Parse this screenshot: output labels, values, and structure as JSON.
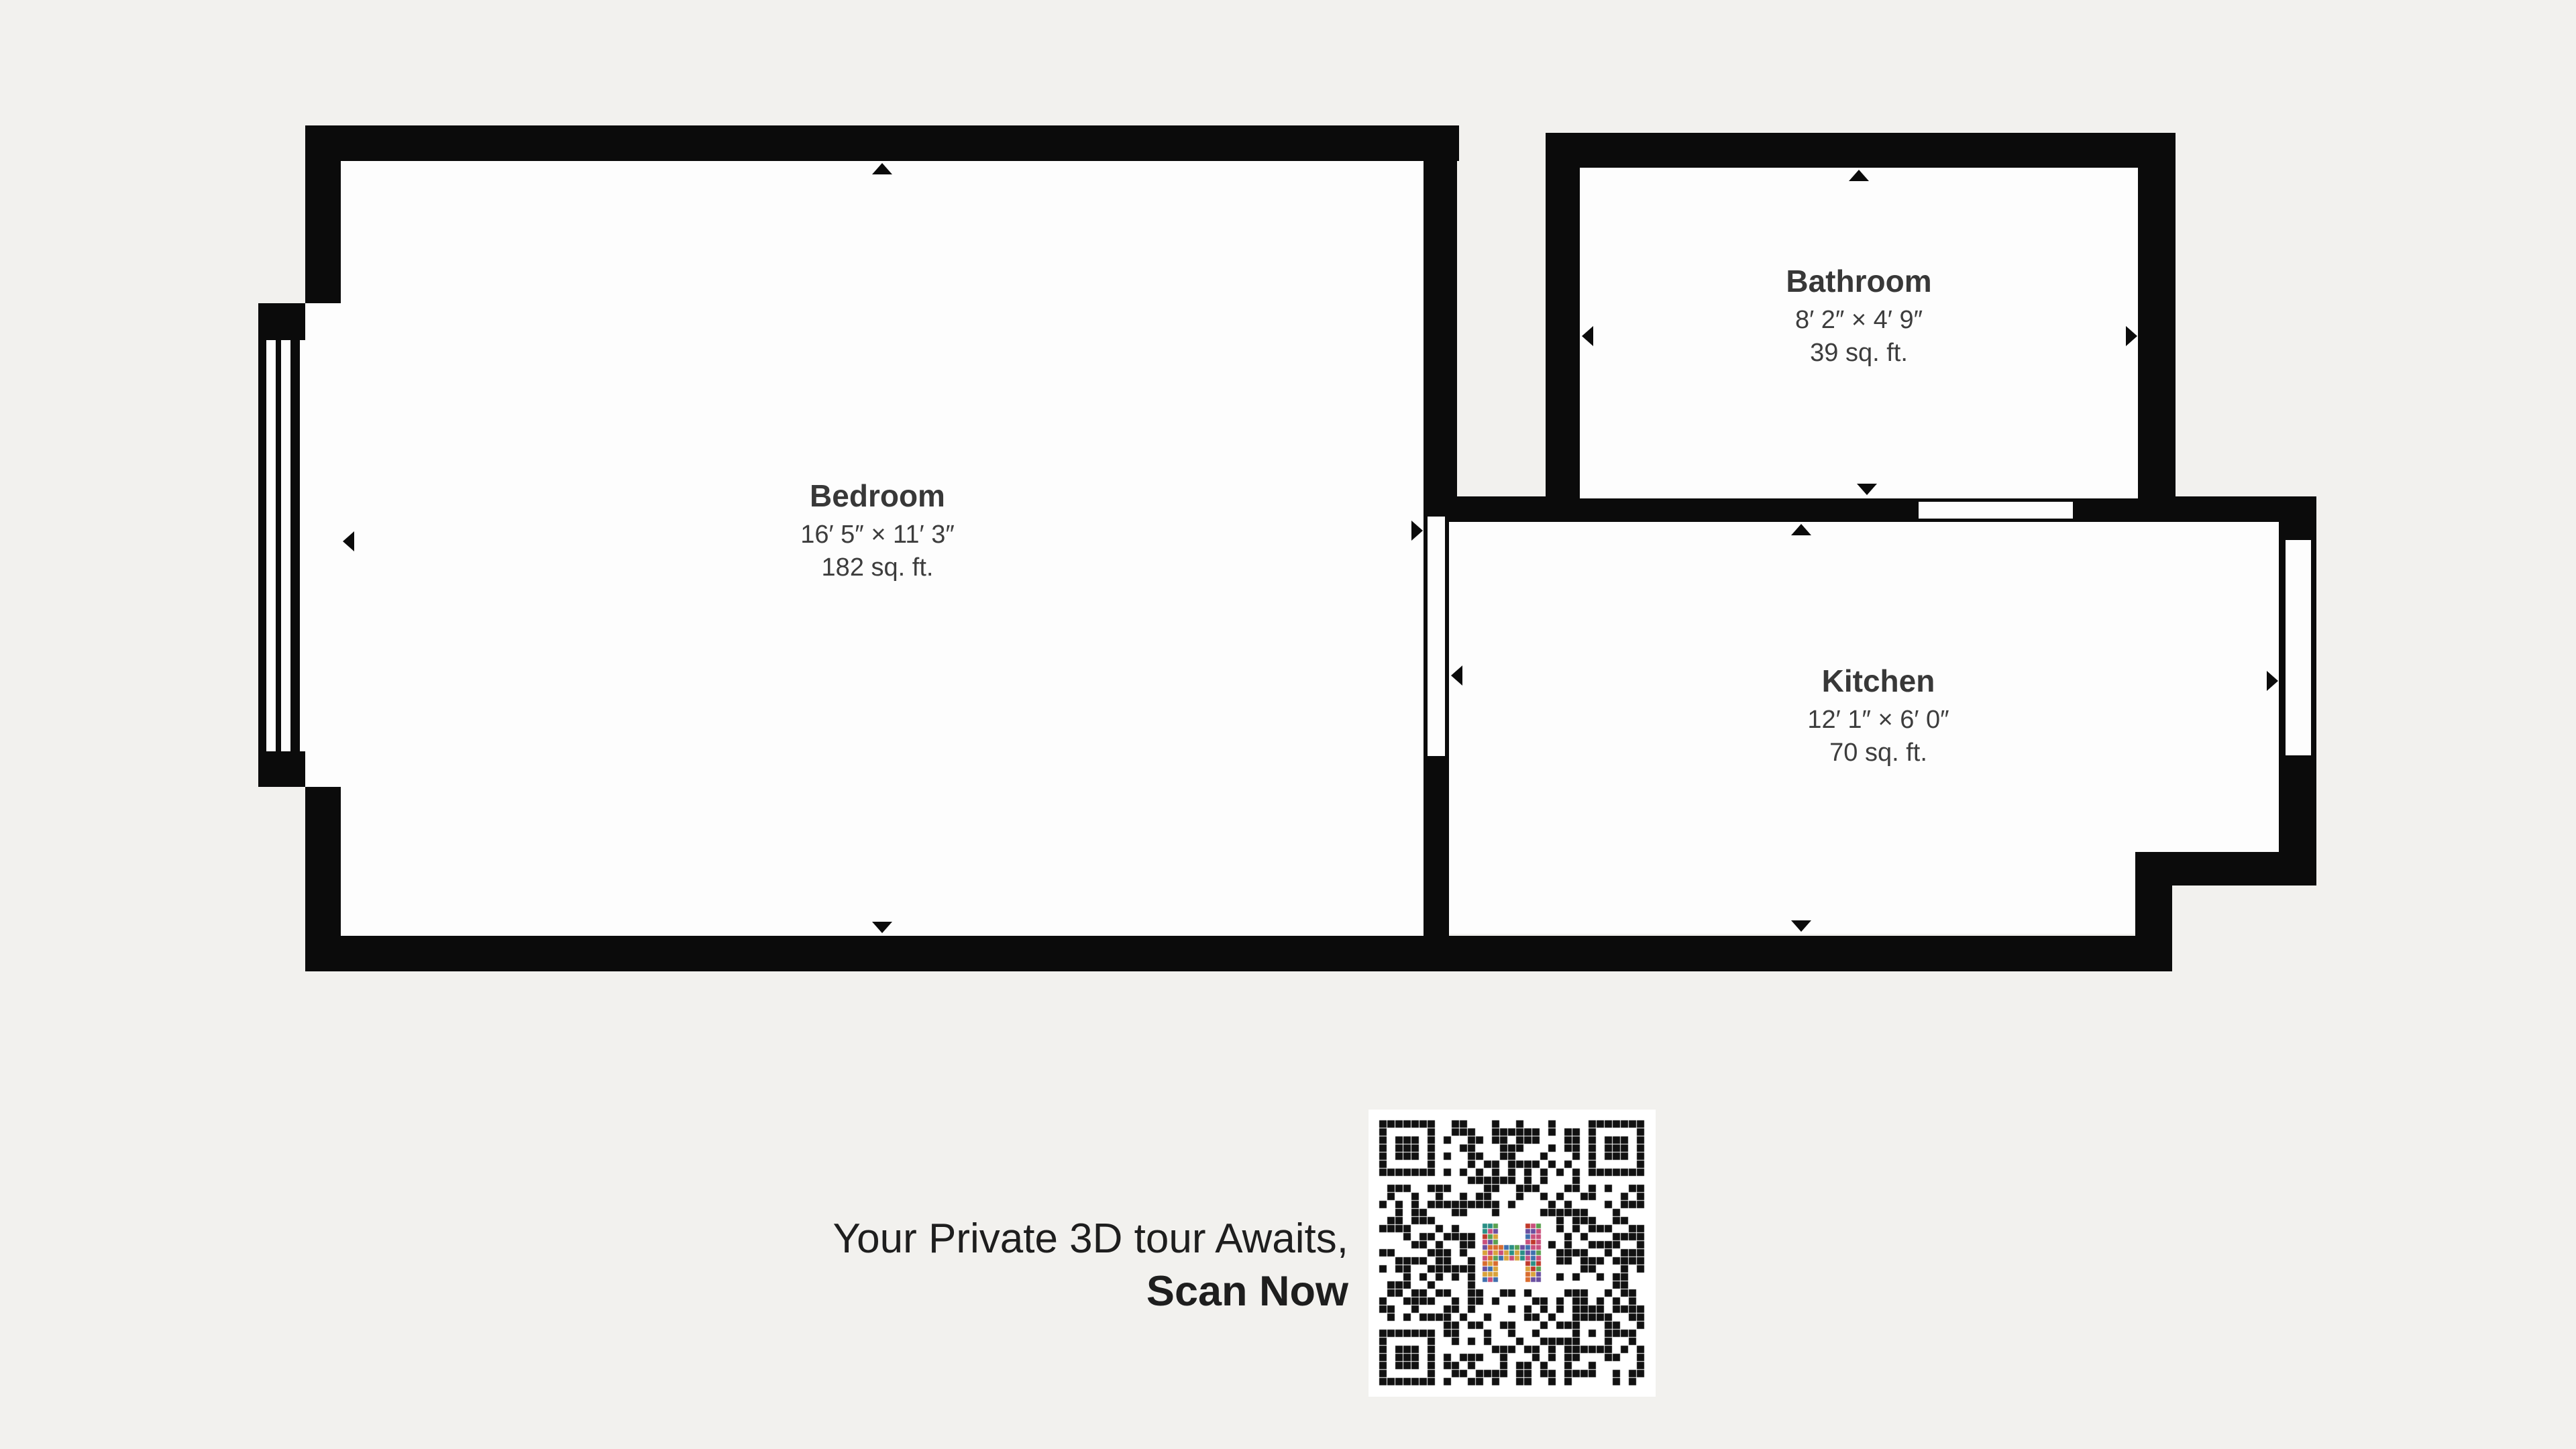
{
  "title": "Apartment floor plan",
  "colors": {
    "background": "#f2f1ee",
    "wall": "#0b0b0b",
    "floor": "#fdfdfd",
    "label": "#3d3d3d",
    "cta": "#1e1e1e"
  },
  "rooms": [
    {
      "name": "Bedroom",
      "dimensions": "16′ 5″ × 11′ 3″",
      "area": "182 sq. ft."
    },
    {
      "name": "Bathroom",
      "dimensions": "8′ 2″ × 4′ 9″",
      "area": "39 sq. ft."
    },
    {
      "name": "Kitchen",
      "dimensions": "12′ 1″ × 6′ 0″",
      "area": "70 sq. ft."
    }
  ],
  "cta": {
    "line1": "Your Private 3D tour Awaits,",
    "line2": "Scan Now"
  },
  "qr": {
    "name": "qr-code",
    "seed": 20240613,
    "modules": 33,
    "dark": "#111111",
    "light": "#ffffff",
    "logo_palette": [
      "#c0392b",
      "#2a8f85",
      "#d9a23a",
      "#3f6fae",
      "#d96c2e",
      "#6a4fa0",
      "#5aa14f",
      "#c94f7c"
    ]
  },
  "icons": {
    "measure_arrow": "triangle-marker"
  }
}
